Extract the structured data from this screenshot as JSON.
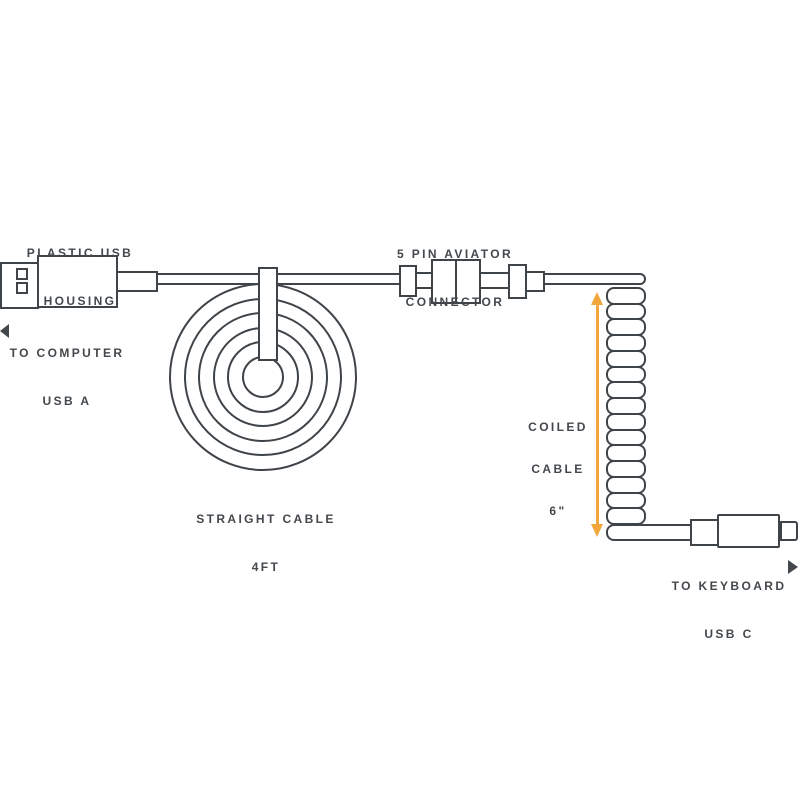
{
  "colors": {
    "line": "#3f4449",
    "text": "#43484d",
    "accent": "#f2a63c",
    "background": "#ffffff"
  },
  "labels": {
    "usb_housing": {
      "line1": "PLASTIC USB",
      "line2": "HOUSING"
    },
    "to_computer": {
      "line1": "TO COMPUTER",
      "line2": "USB A"
    },
    "aviator": {
      "line1": "5 PIN AVIATOR",
      "line2": "CONNECTOR"
    },
    "straight_cable": {
      "line1": "STRAIGHT CABLE",
      "line2": "4FT"
    },
    "coiled_cable": {
      "line1": "COILED",
      "line2": "CABLE",
      "line3": "6\""
    },
    "to_keyboard": {
      "line1": "TO KEYBOARD",
      "line2": "USB C"
    }
  },
  "icons": {
    "to_computer_arrow": "left-triangle",
    "to_keyboard_arrow": "right-triangle",
    "coil_length_arrow": "vertical-double-arrow"
  }
}
